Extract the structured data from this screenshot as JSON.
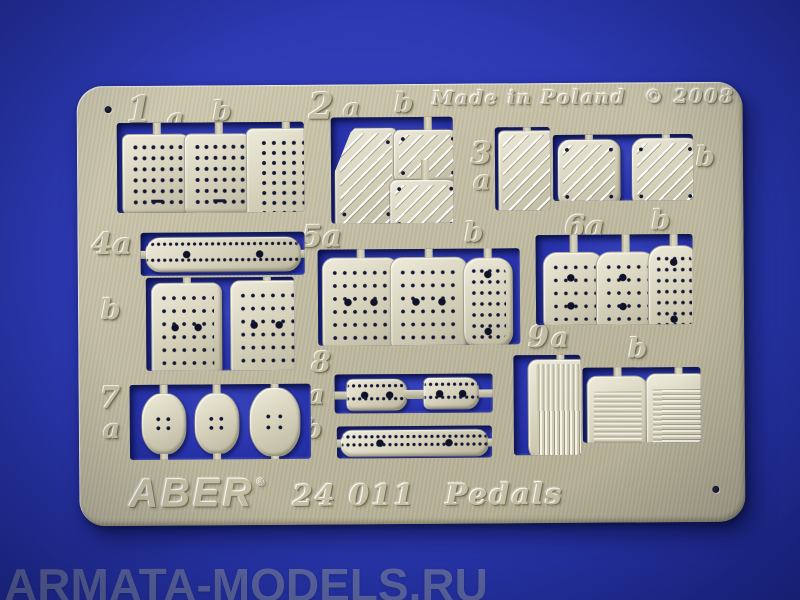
{
  "sheet": {
    "made_in": "Made in Poland",
    "year": "© 2008",
    "brand": "ABER",
    "reg_mark": "®",
    "code": "24 011",
    "name": "Pedals"
  },
  "watermark": "ARMATA-MODELS.RU",
  "part_labels": {
    "g1": {
      "num": "1",
      "a": "a",
      "b": "b"
    },
    "g2": {
      "num": "2",
      "a": "a",
      "b": "b"
    },
    "g3": {
      "num": "3",
      "a": "a",
      "b": "b"
    },
    "g4": {
      "a": "4a",
      "b": "b"
    },
    "g5": {
      "a": "5a",
      "b": "b"
    },
    "g6": {
      "a": "6a",
      "b": "b"
    },
    "g7": {
      "num": "7",
      "a": "a"
    },
    "g8": {
      "num": "8",
      "a": "a",
      "b": "b"
    },
    "g9": {
      "num": "9",
      "a": "a",
      "b": "b"
    }
  },
  "colors": {
    "background_blue": "#2b38b2",
    "fret_metal": "#c0bba2",
    "part_metal": "#ddd9c3",
    "hole_dark": "#10132c",
    "watermark_gray": "#8a93b8"
  }
}
